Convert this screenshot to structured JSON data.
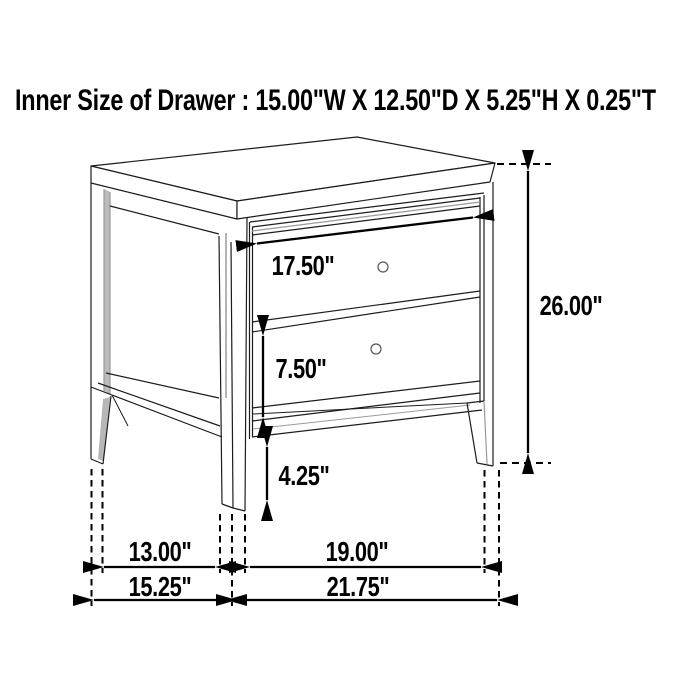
{
  "title": "Inner Size of Drawer : 15.00\"W X 12.50\"D X 5.25\"H X 0.25\"T",
  "diagram_type": "furniture dimension line drawing",
  "item": "two-drawer nightstand",
  "labels": {
    "drawer_opening_width": "17.50\"",
    "overall_height": "26.00\"",
    "drawer_front_height": "7.50\"",
    "leg_clearance_height": "4.25\"",
    "side_leg_spacing": "13.00\"",
    "depth_overall": "15.25\"",
    "front_leg_spacing": "19.00\"",
    "width_overall": "21.75\""
  },
  "colors": {
    "background": "#ffffff",
    "line": "#1c1c1c",
    "dimension": "#000000",
    "shading": "#b9b9b9",
    "text": "#000000"
  }
}
